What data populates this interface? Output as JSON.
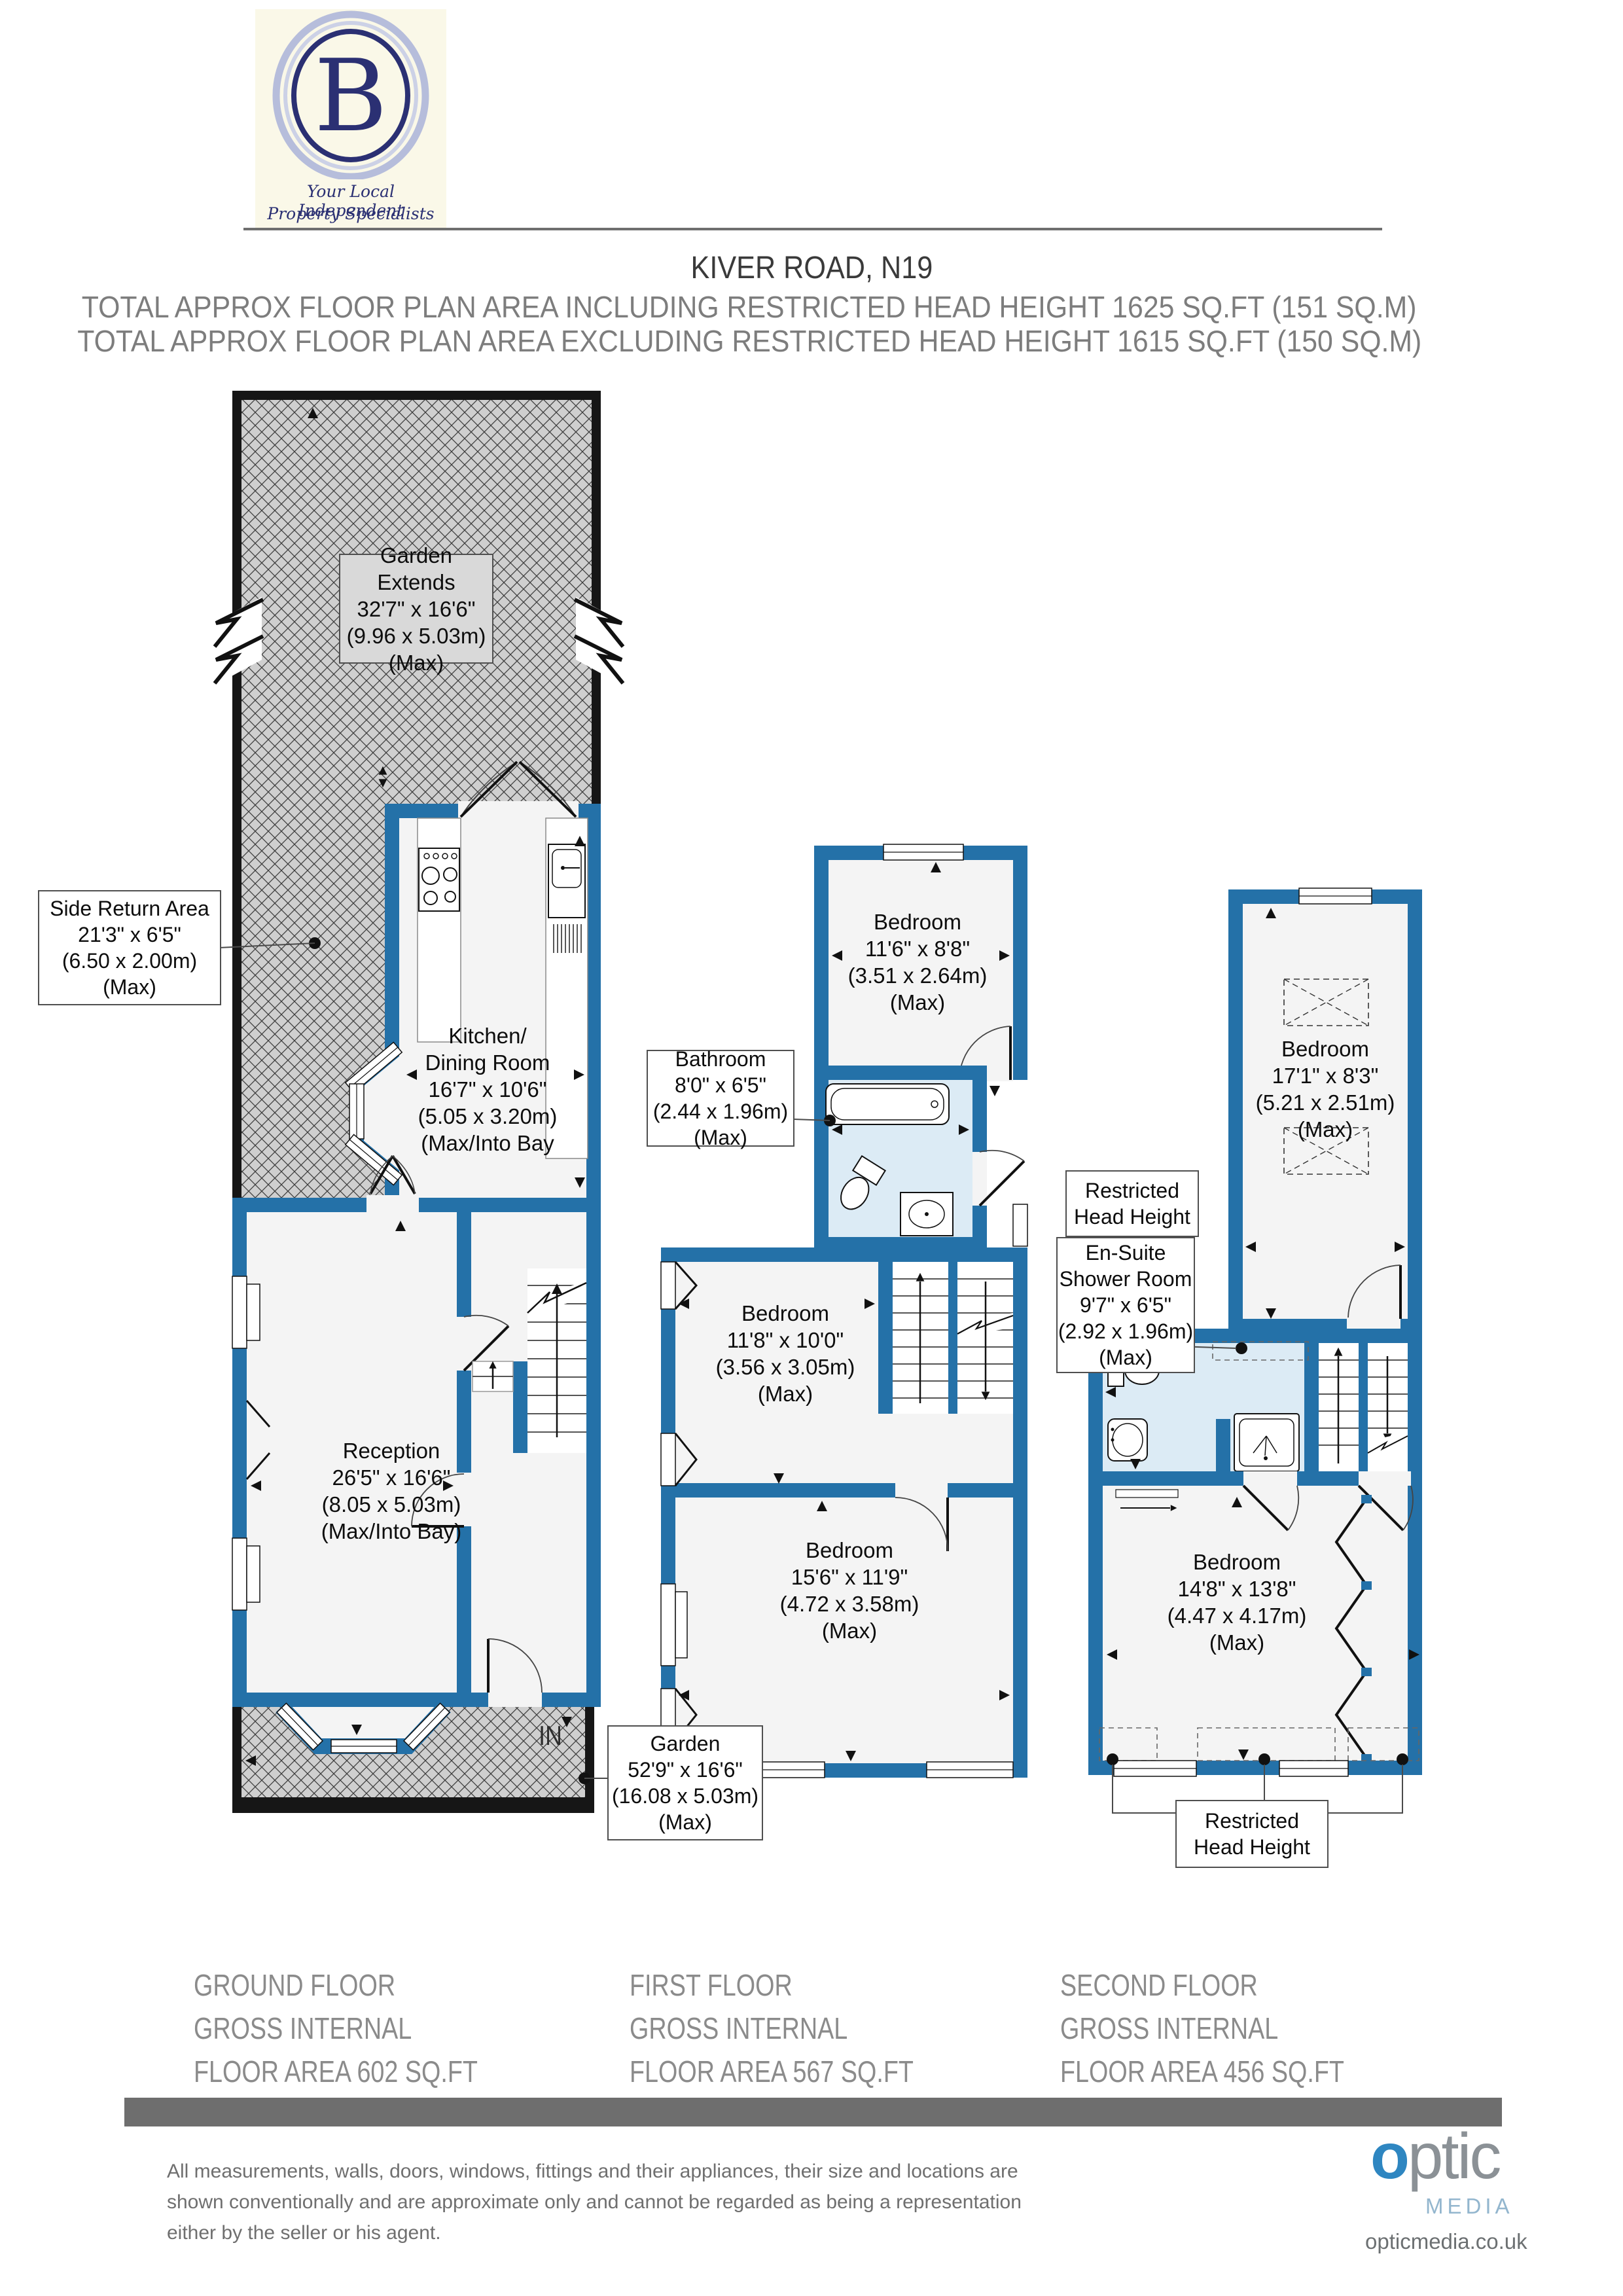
{
  "header": {
    "logo": {
      "letter": "B",
      "tagline_line1": "Your Local Independent",
      "tagline_line2": "Property Specialists"
    },
    "title": "KIVER ROAD, N19",
    "total_line1": "TOTAL APPROX FLOOR PLAN AREA INCLUDING RESTRICTED HEAD HEIGHT  1625 SQ.FT (151 SQ.M)",
    "total_line2": "TOTAL APPROX FLOOR PLAN AREA EXCLUDING RESTRICTED HEAD HEIGHT  1615 SQ.FT (150 SQ.M)"
  },
  "plans": {
    "ground": {
      "garden_extends": [
        "Garden Extends",
        "32'7\" x 16'6\"",
        "(9.96 x 5.03m)",
        "(Max)"
      ],
      "side_return": [
        "Side Return Area",
        "21'3\" x 6'5\"",
        "(6.50 x 2.00m)",
        "(Max)"
      ],
      "kitchen": [
        "Kitchen/",
        "Dining Room",
        "16'7\" x 10'6\"",
        "(5.05 x 3.20m)",
        "(Max/Into Bay"
      ],
      "reception": [
        "Reception",
        "26'5\" x 16'6\"",
        "(8.05 x 5.03m)",
        "(Max/Into Bay)"
      ],
      "garden": [
        "Garden",
        "52'9\" x 16'6\"",
        "(16.08 x 5.03m)",
        "(Max)"
      ],
      "in_label": "IN",
      "floor_label": [
        "GROUND FLOOR",
        "GROSS INTERNAL",
        "FLOOR AREA 602 SQ.FT"
      ]
    },
    "first": {
      "bedroom_rear": [
        "Bedroom",
        "11'6\" x 8'8\"",
        "(3.51 x 2.64m)",
        "(Max)"
      ],
      "bathroom": [
        "Bathroom",
        "8'0\" x 6'5\"",
        "(2.44 x 1.96m)",
        "(Max)"
      ],
      "bedroom_middle": [
        "Bedroom",
        "11'8\" x 10'0\"",
        "(3.56 x 3.05m)",
        "(Max)"
      ],
      "bedroom_front": [
        "Bedroom",
        "15'6\" x 11'9\"",
        "(4.72 x 3.58m)",
        "(Max)"
      ],
      "floor_label": [
        "FIRST FLOOR",
        "GROSS INTERNAL",
        "FLOOR AREA 567 SQ.FT"
      ]
    },
    "second": {
      "bedroom_rear": [
        "Bedroom",
        "17'1\" x 8'3\"",
        "(5.21 x 2.51m)",
        "(Max)"
      ],
      "restricted_top": [
        "Restricted",
        "Head Height"
      ],
      "ensuite": [
        "En-Suite",
        "Shower Room",
        "9'7\" x 6'5\"",
        "(2.92 x 1.96m)",
        "(Max)"
      ],
      "bedroom_front": [
        "Bedroom",
        "14'8\" x 13'8\"",
        "(4.47 x 4.17m)",
        "(Max)"
      ],
      "restricted_bottom": [
        "Restricted",
        "Head Height"
      ],
      "floor_label": [
        "SECOND FLOOR",
        "GROSS INTERNAL",
        "FLOOR AREA 456 SQ.FT"
      ]
    }
  },
  "footer": {
    "disclaimer": [
      "All measurements, walls, doors, windows, fittings and their appliances, their size and locations are",
      "shown conventionally and are approximate only and cannot be regarded as being a representation",
      "either by the seller or his agent."
    ],
    "brand": {
      "word_o": "o",
      "word_rest": "ptic",
      "media": "MEDIA",
      "url": "opticmedia.co.uk"
    }
  },
  "colors": {
    "wall_blue": "#2471A8",
    "wet_room_fill": "#dcebf5",
    "room_fill": "#f4f4f4",
    "hatch_fill": "#cfcfcf",
    "black_wall": "#161616",
    "heading_gray": "#7d7d7d",
    "floor_label_gray": "#8b8b8b",
    "logo_navy": "#2b3073",
    "brand_blue": "#2e86c1"
  }
}
